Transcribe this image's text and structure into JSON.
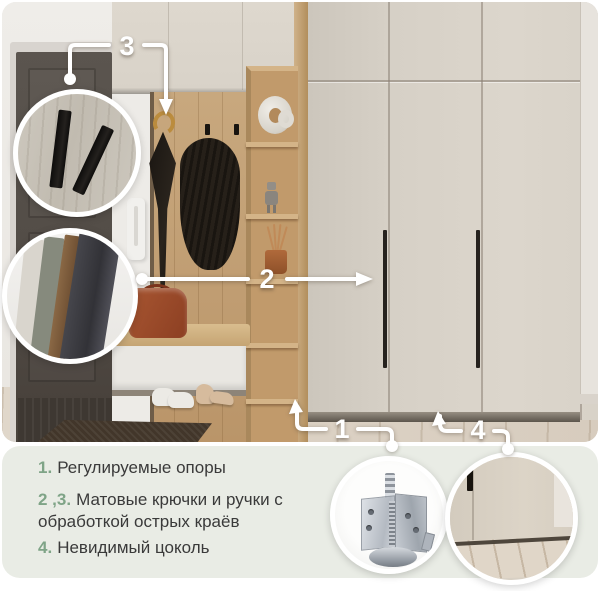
{
  "card": {
    "callouts": {
      "n1": "1",
      "n2": "2",
      "n3": "3",
      "n4": "4"
    },
    "legend": [
      {
        "num": "1.",
        "text": "Регулируемые опоры"
      },
      {
        "num": "2 ,3.",
        "text": "Матовые крючки и ручки с обработкой острых краёв"
      },
      {
        "num": "4.",
        "text": "Невидимый цоколь"
      }
    ],
    "colors": {
      "accent_green": "#7fa487",
      "legend_text": "#3a3a3a",
      "panel_bg": "#e9ece5",
      "callout_white": "#ffffff",
      "wardrobe_front": "#d6d0c6",
      "oak_wood": "#c3a178"
    },
    "insets": {
      "top_first": "matte-black-hook-closeup",
      "top_second": "matte-handles-closeup",
      "bottom_first": "adjustable-leveler-foot-closeup",
      "bottom_second": "hidden-plinth-bottom-closeup"
    }
  }
}
